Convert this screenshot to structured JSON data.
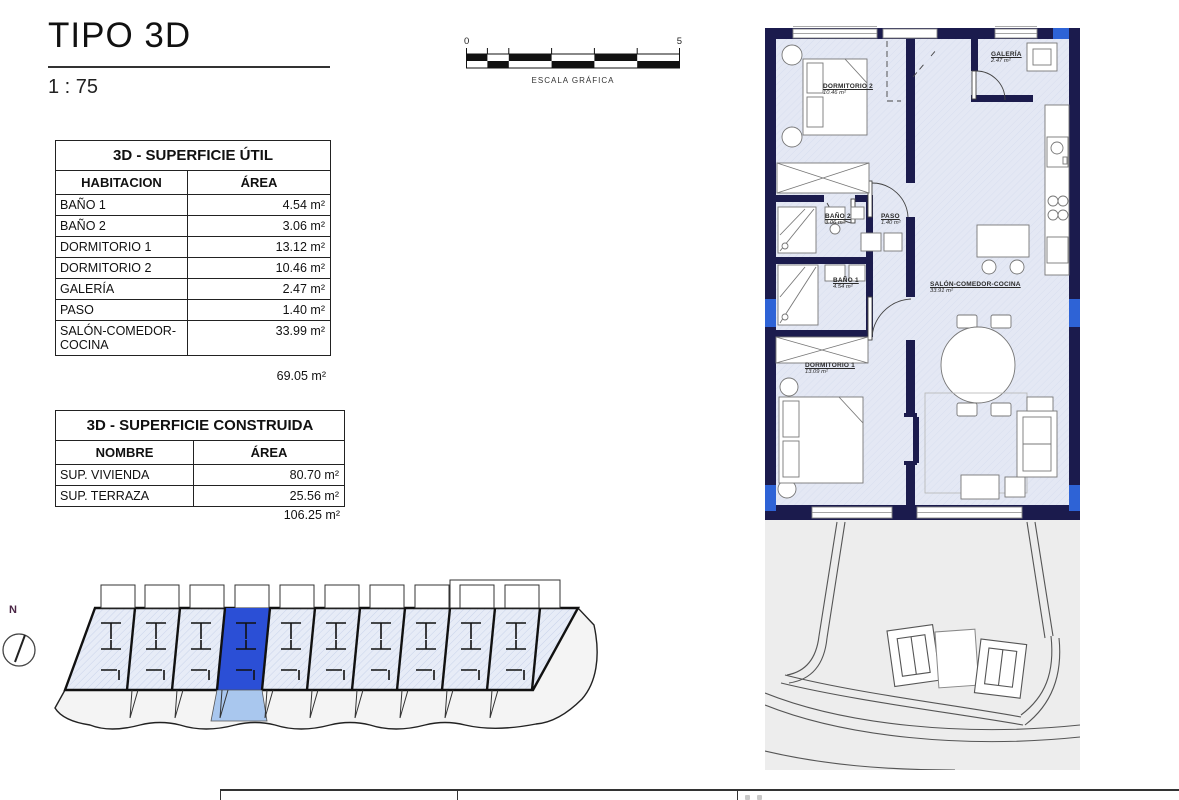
{
  "title": {
    "name": "TIPO 3D",
    "scale": "1 : 75"
  },
  "scale_bar": {
    "start": "0",
    "end": "5",
    "label": "ESCALA GRÁFICA"
  },
  "surface_util": {
    "title": "3D - SUPERFICIE ÚTIL",
    "headers": {
      "room": "HABITACION",
      "area": "ÁREA"
    },
    "rows": [
      {
        "name": "BAÑO 1",
        "area": "4.54 m²"
      },
      {
        "name": "BAÑO 2",
        "area": "3.06 m²"
      },
      {
        "name": "DORMITORIO 1",
        "area": "13.12 m²"
      },
      {
        "name": "DORMITORIO 2",
        "area": "10.46 m²"
      },
      {
        "name": "GALERÍA",
        "area": "2.47 m²"
      },
      {
        "name": "PASO",
        "area": "1.40 m²"
      },
      {
        "name": "SALÓN-COMEDOR-COCINA",
        "area": "33.99 m²"
      }
    ],
    "total": "69.05 m²"
  },
  "surface_construida": {
    "title": "3D - SUPERFICIE CONSTRUIDA",
    "headers": {
      "name": "NOMBRE",
      "area": "ÁREA"
    },
    "rows": [
      {
        "name": "SUP. VIVIENDA",
        "area": "80.70 m²"
      },
      {
        "name": "SUP. TERRAZA",
        "area": "25.56 m²"
      }
    ],
    "total": "106.25 m²"
  },
  "compass": {
    "label": "N"
  },
  "floor_plan": {
    "rooms": {
      "dormitorio2": {
        "name": "DORMITORIO 2",
        "area": "10.46 m²"
      },
      "galeria": {
        "name": "GALERÍA",
        "area": "2.47 m²"
      },
      "bano2": {
        "name": "BAÑO 2",
        "area": "3.06 m²"
      },
      "paso": {
        "name": "PASO",
        "area": "1.40 m²"
      },
      "bano1": {
        "name": "BAÑO 1",
        "area": "4.54 m²"
      },
      "salon": {
        "name": "SALÓN-COMEDOR-COCINA",
        "area": "33.91 m²"
      },
      "dormitorio1": {
        "name": "DORMITORIO 1",
        "area": "13.09 m²"
      }
    }
  },
  "colors": {
    "wall": "#1b1b4d",
    "floor": "#e4e8f4",
    "highlight_unit": "#2b4fd6",
    "highlight_terrace": "#a9c7ee",
    "window_accent": "#2e63d6"
  }
}
